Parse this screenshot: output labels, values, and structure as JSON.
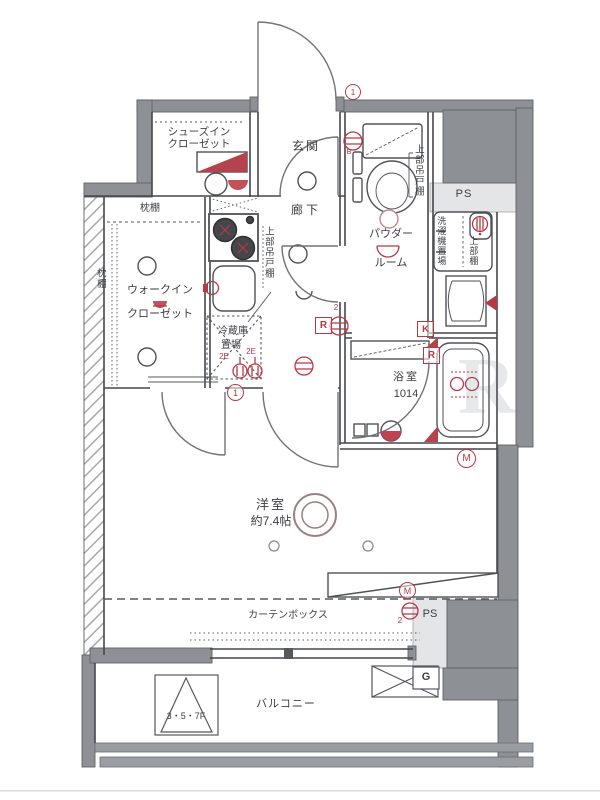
{
  "title": "apartment-floor-plan",
  "colors": {
    "wall": "#8d9095",
    "wall_light": "#e4e5e7",
    "line": "#45474b",
    "red_annotation": "#b53a45",
    "background": "#ffffff"
  },
  "rooms": {
    "shoes_closet": [
      "シューズイン",
      "クローゼット"
    ],
    "entrance": "玄関",
    "corridor": "廊下",
    "powder_room": [
      "パウダー",
      "ルーム"
    ],
    "walk_in_closet": [
      "ウォークイン",
      "クローゼット"
    ],
    "bathroom": [
      "浴室",
      "1014"
    ],
    "bedroom": [
      "洋室",
      "約7.4帖"
    ],
    "balcony": "バルコニー"
  },
  "fixtures": {
    "pillow_shelf_top": "枕棚",
    "pillow_shelf_side": "枕棚",
    "upper_cabinet_kitchen": "上部吊戸棚",
    "upper_cabinet_toilet": "上部吊戸棚",
    "refrigerator": [
      "冷蔵庫",
      "置場"
    ],
    "washing_machine": "洗濯機置場",
    "upper_shelf": "上部棚",
    "curtain_box": "カーテンボックス",
    "evacuation_hatch": "3・5・7F"
  },
  "marks": {
    "ps_top": "PS",
    "ps_bottom": "PS",
    "gas": "G",
    "kitchen_k": "K",
    "r_corridor": "R",
    "r_bathroom": "R",
    "m_bathroom": "M",
    "m_bedroom": "M",
    "b_toilet": "B",
    "circled_one_entrance": "1",
    "circled_one_kitchen": "1",
    "two_corridor": "2",
    "two_bedroom": "2",
    "outlet_2e_left": "2E",
    "outlet_2e_right": "2E"
  },
  "watermark": "R"
}
